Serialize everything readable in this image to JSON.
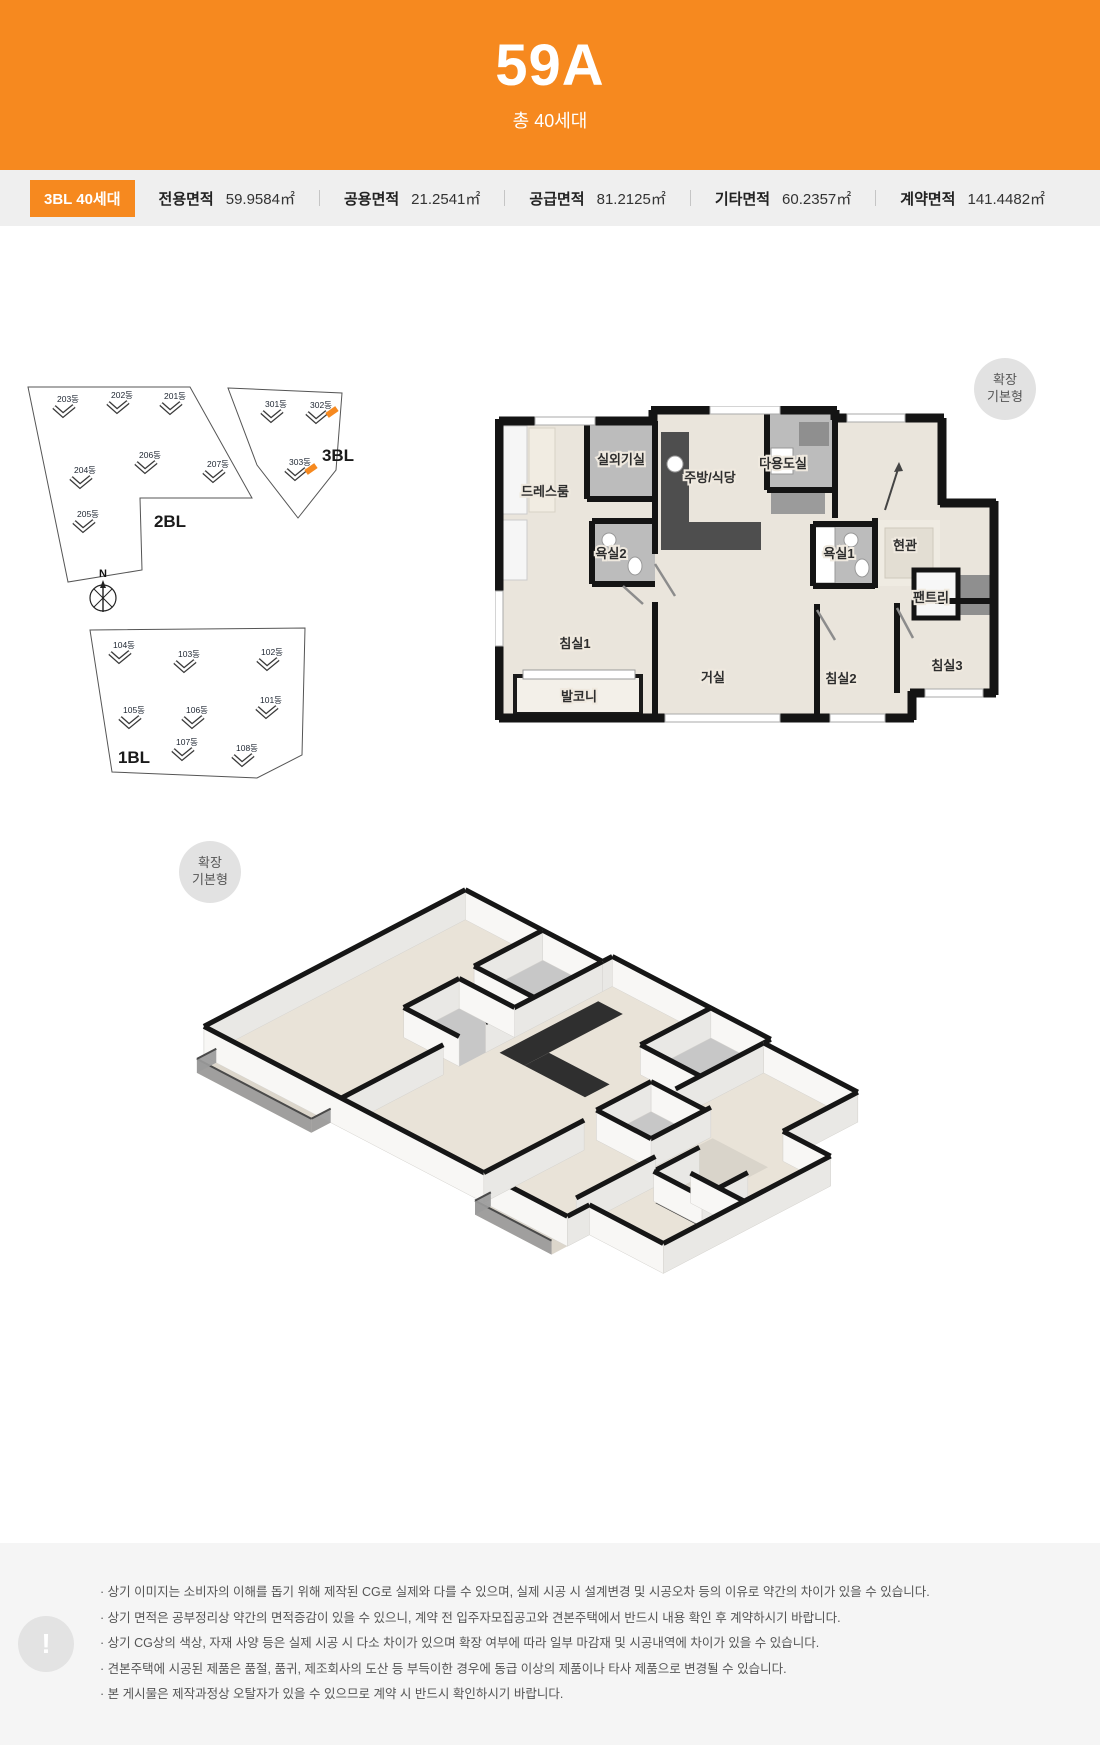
{
  "header": {
    "title": "59A",
    "subtitle": "총 40세대"
  },
  "stats": {
    "badge": "3BL 40세대",
    "items": [
      {
        "label": "전용면적",
        "value": "59.9584㎡"
      },
      {
        "label": "공용면적",
        "value": "21.2541㎡"
      },
      {
        "label": "공급면적",
        "value": "81.2125㎡"
      },
      {
        "label": "기타면적",
        "value": "60.2357㎡"
      },
      {
        "label": "계약면적",
        "value": "141.4482㎡"
      }
    ]
  },
  "site_plan": {
    "compass": "N",
    "block_labels": [
      "2BL",
      "3BL",
      "1BL"
    ],
    "highlight_color": "#F6891F",
    "buildings": [
      {
        "name": "203동"
      },
      {
        "name": "202동"
      },
      {
        "name": "201동"
      },
      {
        "name": "206동"
      },
      {
        "name": "207동"
      },
      {
        "name": "204동"
      },
      {
        "name": "205동"
      },
      {
        "name": "301동"
      },
      {
        "name": "302동",
        "highlighted": true
      },
      {
        "name": "303동",
        "highlighted": true
      },
      {
        "name": "104동"
      },
      {
        "name": "103동"
      },
      {
        "name": "102동"
      },
      {
        "name": "105동"
      },
      {
        "name": "106동"
      },
      {
        "name": "101동"
      },
      {
        "name": "107동"
      },
      {
        "name": "108동"
      }
    ]
  },
  "floor_plan": {
    "badge_line1": "확장",
    "badge_line2": "기본형",
    "rooms": [
      {
        "name": "실외기실"
      },
      {
        "name": "드레스룸"
      },
      {
        "name": "주방/식당"
      },
      {
        "name": "다용도실"
      },
      {
        "name": "욕실2"
      },
      {
        "name": "욕실1"
      },
      {
        "name": "현관"
      },
      {
        "name": "팬트리"
      },
      {
        "name": "침실1"
      },
      {
        "name": "거실"
      },
      {
        "name": "침실2"
      },
      {
        "name": "침실3"
      },
      {
        "name": "발코니"
      }
    ]
  },
  "iso_view": {
    "badge_line1": "확장",
    "badge_line2": "기본형"
  },
  "notes": {
    "icon": "!",
    "items": [
      "상기 이미지는 소비자의 이해를 돕기 위해 제작된 CG로 실제와 다를 수 있으며, 실제 시공 시 설계변경 및 시공오차 등의 이유로 약간의 차이가 있을 수 있습니다.",
      "상기 면적은 공부정리상 약간의 면적증감이 있을 수 있으니, 계약 전 입주자모집공고와 견본주택에서 반드시 내용 확인 후 계약하시기 바랍니다.",
      "상기 CG상의 색상, 자재 사양 등은 실제 시공 시 다소 차이가 있으며 확장 여부에 따라 일부 마감재 및 시공내역에 차이가 있을 수 있습니다.",
      "견본주택에 시공된 제품은 품절, 품귀, 제조회사의 도산 등 부득이한 경우에 동급 이상의 제품이나 타사 제품으로 변경될 수 있습니다.",
      "본 게시물은 제작과정상 오탈자가 있을 수 있으므로 계약 시 반드시 확인하시기 바랍니다."
    ]
  }
}
